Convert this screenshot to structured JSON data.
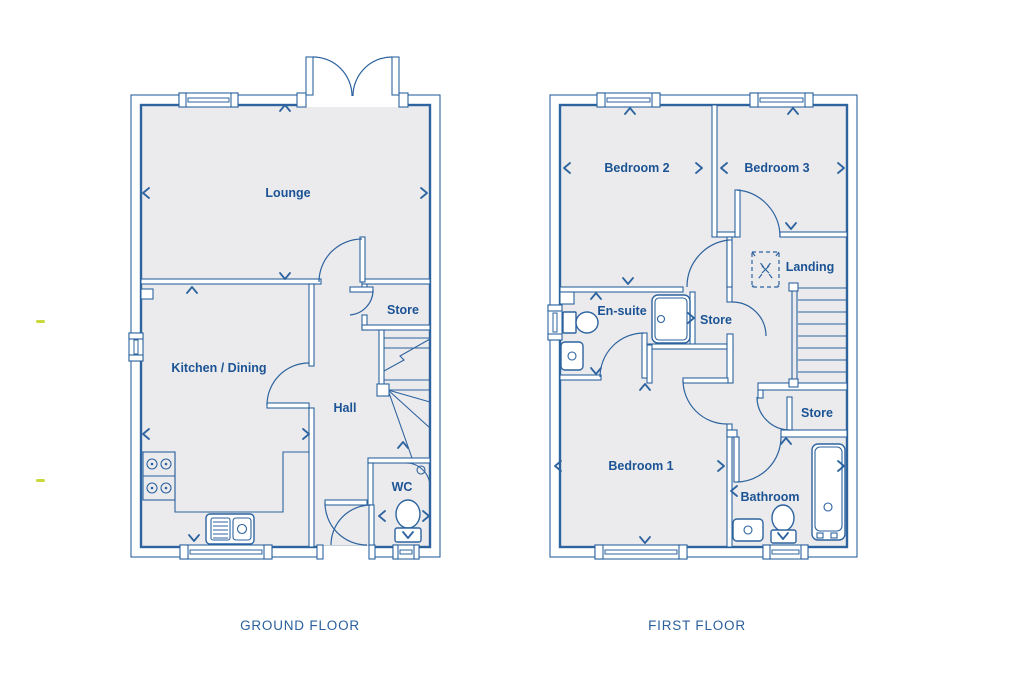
{
  "ground_floor": {
    "title": "GROUND FLOOR",
    "rooms": {
      "lounge": "Lounge",
      "kitchen_dining": "Kitchen / Dining",
      "hall": "Hall",
      "store": "Store",
      "wc": "WC"
    }
  },
  "first_floor": {
    "title": "FIRST FLOOR",
    "rooms": {
      "bedroom2": "Bedroom 2",
      "bedroom3": "Bedroom 3",
      "landing": "Landing",
      "en_suite": "En-suite",
      "store_middle": "Store",
      "store_right": "Store",
      "bedroom1": "Bedroom 1",
      "bathroom": "Bathroom"
    }
  },
  "colors": {
    "wall_line": "#2d639f",
    "room_label": "#1b5394",
    "floor_fill": "#ebebed",
    "accent_dash": "#c9d83a"
  }
}
